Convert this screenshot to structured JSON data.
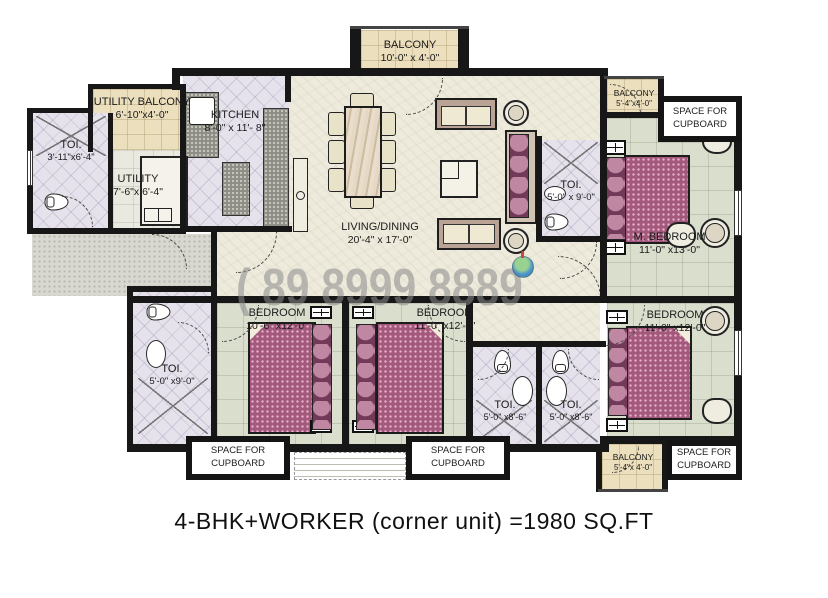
{
  "title": "4-BHK+WORKER (corner unit)  =1980 SQ.FT",
  "watermark": {
    "phone": "( 89 8999 8889",
    "logo": "globe-icon"
  },
  "labels": {
    "cupboard": "SPACE FOR CUPBOARD"
  },
  "icons": {
    "wc": "toilet-icon",
    "basin": "washbasin-icon",
    "shower": "shower-hatch-icon",
    "globe": "globe-watermark-icon"
  },
  "rooms": {
    "balcony_top": {
      "name": "BALCONY",
      "dims": "10'-0\" x 4'-0\""
    },
    "utility_balcony": {
      "name": "UTILITY BALCONY",
      "dims": "6'-10\"x4'-0\""
    },
    "kitchen": {
      "name": "KITCHEN",
      "dims": "8'-0\" x 11'- 8\""
    },
    "toi_left": {
      "name": "TOI.",
      "dims": "3'-11\"x6'-4\""
    },
    "utility": {
      "name": "UTILITY",
      "dims": "7'-6\"x 6'-4\""
    },
    "living": {
      "name": "LIVING/DINING",
      "dims": "20'-4\" x 17'-0\""
    },
    "toi_master": {
      "name": "TOI.",
      "dims": "5'-0\" x 9'-0\""
    },
    "m_bedroom": {
      "name": "M. BEDROOM",
      "dims": "11'-0\" x13'-0\""
    },
    "balcony_top_right": {
      "name": "BALCONY",
      "dims": "5'-4\"x4'-0\""
    },
    "bedroom_left": {
      "name": "BEDROOM",
      "dims": "10'-6\" x12'-0\""
    },
    "bedroom_mid": {
      "name": "BEDROOM",
      "dims": "11'-0\" x12'-0\""
    },
    "bedroom_right": {
      "name": "BEDROOM",
      "dims": "11'-0\" x12'-0\""
    },
    "toi_bottom_left": {
      "name": "TOI.",
      "dims": "5'-0\" x9'-0\""
    },
    "toi_bottom_1": {
      "name": "TOI.",
      "dims": "5'-0\" x8'-6\""
    },
    "toi_bottom_2": {
      "name": "TOI.",
      "dims": "5'-0\" x8'-6\""
    },
    "balcony_bottom_right": {
      "name": "BALCONY",
      "dims": "5'-4\"x 4'-0\""
    }
  }
}
